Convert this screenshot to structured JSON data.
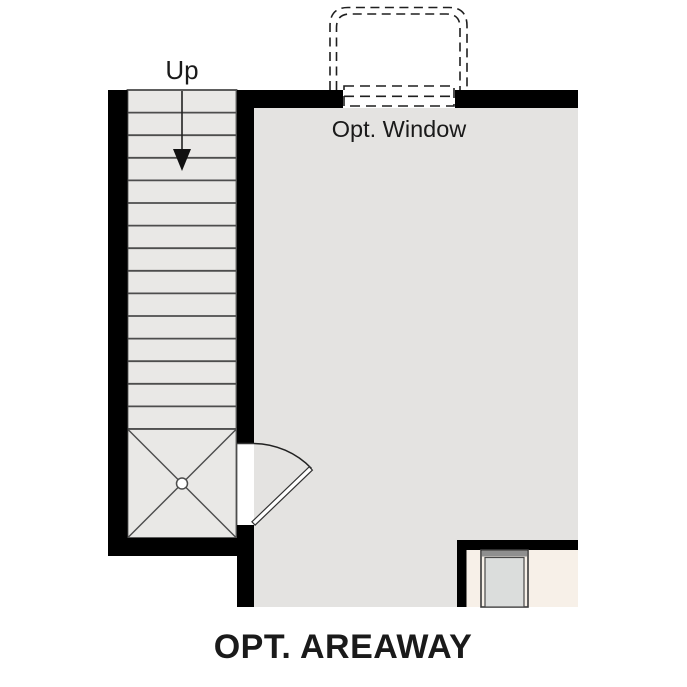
{
  "plan": {
    "title": "OPT. AREAWAY",
    "labels": {
      "up": "Up",
      "window": "Opt. Window"
    }
  },
  "colors": {
    "background": "#ffffff",
    "wall": "#000000",
    "room_floor": "#e4e3e1",
    "stair_tread": "#e9e8e6",
    "adjacent_floor": "#f7f0e8",
    "door_panel": "#dbdddc",
    "door_frame": "#8f8f8f",
    "tread_line": "#4d4d4d",
    "dashed_line": "#1f1f1f",
    "text": "#1a1a1a"
  }
}
